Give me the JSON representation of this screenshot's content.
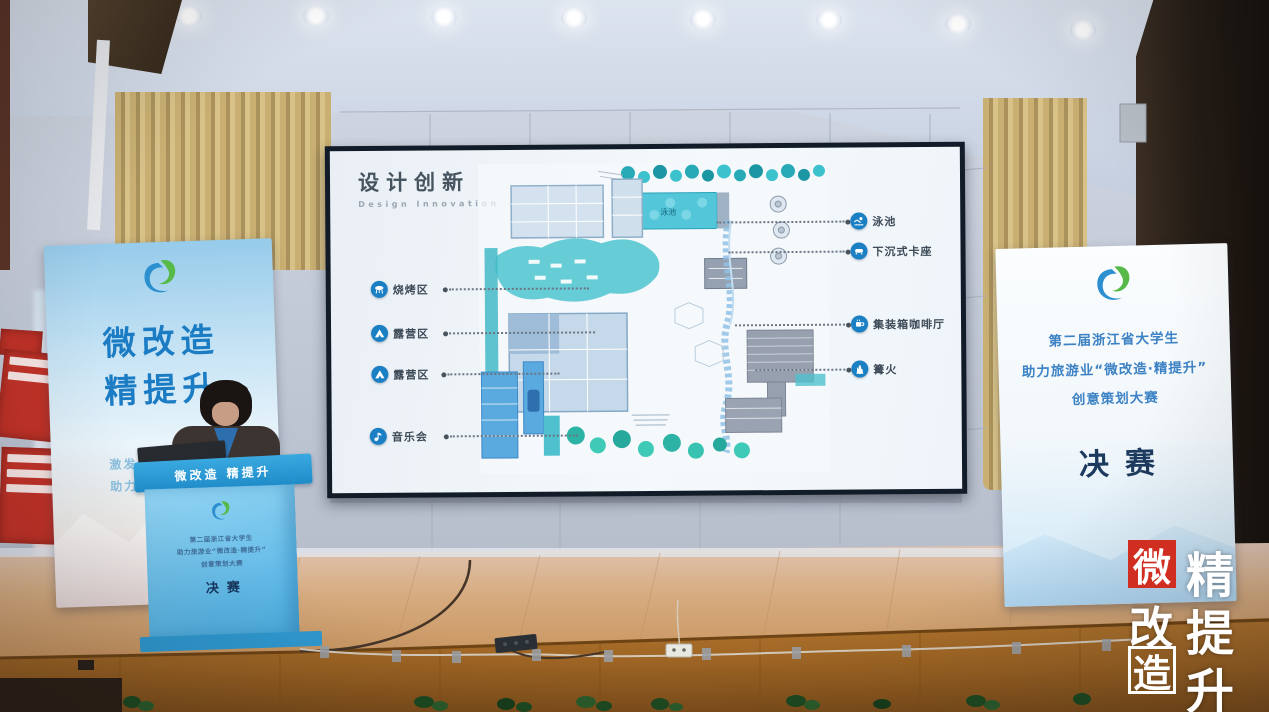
{
  "slide": {
    "title": "设计创新",
    "subtitle": "Design Innovation",
    "left_labels": [
      {
        "icon": "grill-icon",
        "label": "烧烤区"
      },
      {
        "icon": "tent-icon",
        "label": "露营区"
      },
      {
        "icon": "tent-icon",
        "label": "露营区"
      },
      {
        "icon": "music-icon",
        "label": "音乐会"
      }
    ],
    "right_labels": [
      {
        "icon": "swim-icon",
        "label": "泳池"
      },
      {
        "icon": "sofa-icon",
        "label": "下沉式卡座"
      },
      {
        "icon": "coffee-icon",
        "label": "集装箱咖啡厅"
      },
      {
        "icon": "bonfire-icon",
        "label": "篝火"
      }
    ],
    "plan": {
      "pool_label": "泳池"
    }
  },
  "left_banner": {
    "title_line1": "微改造",
    "title_line2": "精提升",
    "subtitle_line1": "激发青春无限创意",
    "subtitle_line2": "助力文旅深度融合"
  },
  "right_banner": {
    "line1": "第二届浙江省大学生",
    "line2": "助力旅游业“微改造·精提升”",
    "line3": "创意策划大赛",
    "final_label": "决赛"
  },
  "podium": {
    "header": "微改造  精提升",
    "line1": "第二届浙江省大学生",
    "line2": "助力旅游业“微改造·精提升”",
    "line3": "创意策划大赛",
    "final_label": "决赛"
  },
  "watermark": {
    "left_col": [
      "微",
      "改",
      "造"
    ],
    "right_col": [
      "精",
      "提",
      "升"
    ]
  },
  "colors": {
    "accent_blue": "#1f7dc2",
    "teal": "#3fbccb",
    "banner_navy": "#1c3a5e",
    "gold_curtain": "#c4aa6b",
    "stage_wood": "#c08b52",
    "logo_red": "#cf2e21"
  }
}
